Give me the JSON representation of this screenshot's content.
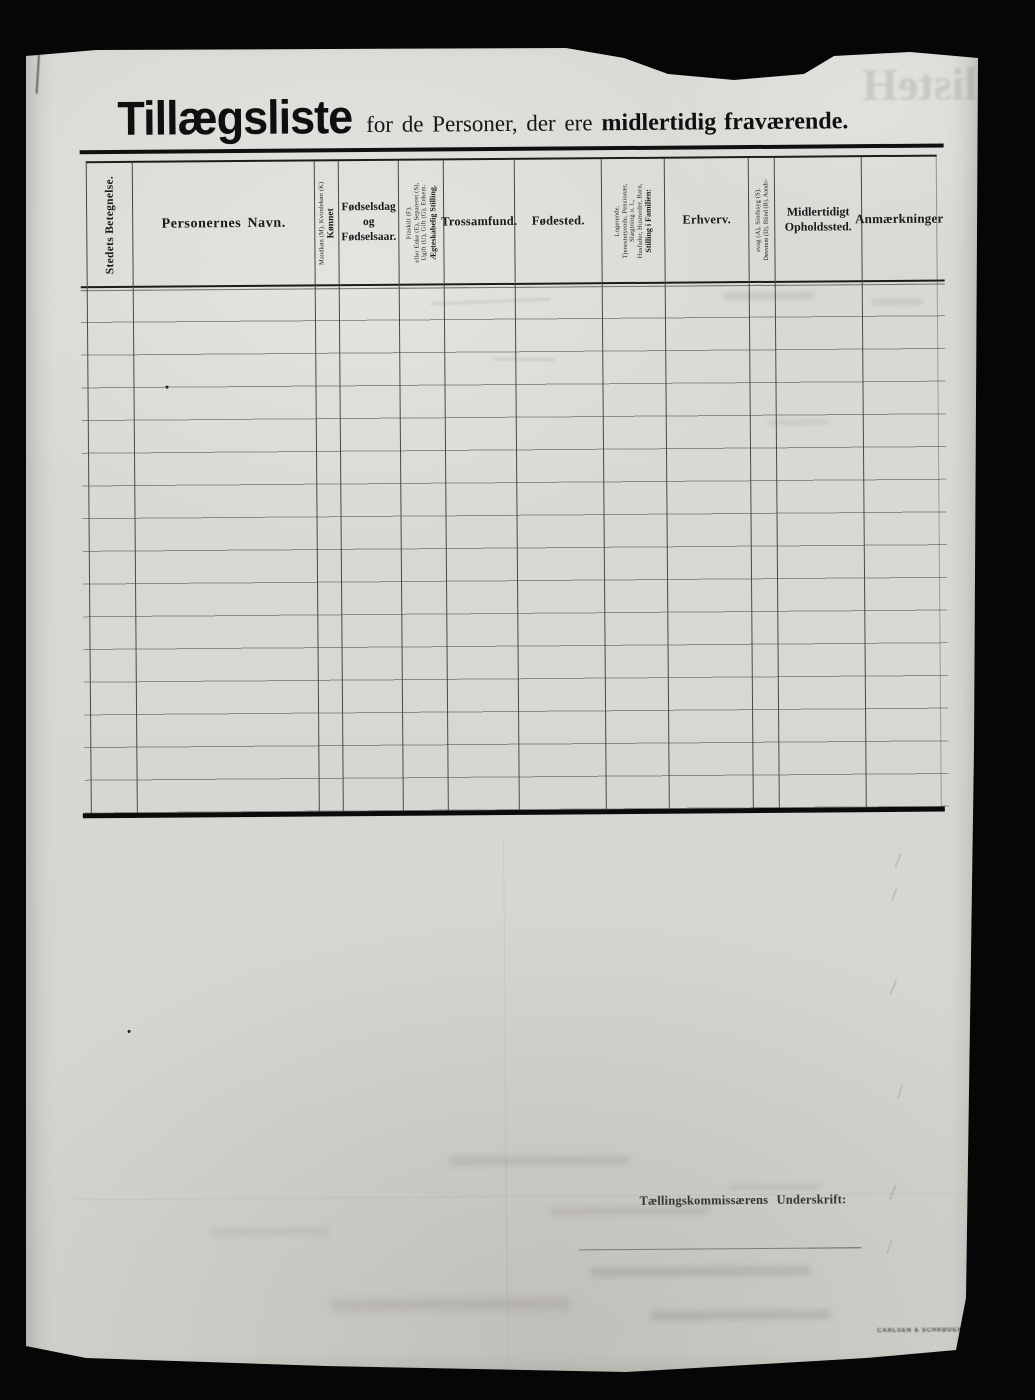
{
  "document": {
    "ghost_bleedthrough": "listeH",
    "title": {
      "main": "Tillægsliste",
      "mid": "for de Personer, der ere",
      "emphasis": "midlertidig fraværende."
    },
    "signature_label": "Tællingskommissærens Underskrift:",
    "printer_mark": "CARLSEN & SCHRØDER"
  },
  "table": {
    "row_count": 16,
    "columns": [
      {
        "key": "stedets_betegnelse",
        "orientation": "vertical",
        "main": "Stedets Betegnelse.",
        "sub": []
      },
      {
        "key": "personernes_navn",
        "orientation": "horizontal",
        "lines": [
          "Personernes Navn."
        ]
      },
      {
        "key": "kjonnet",
        "orientation": "vertical",
        "main": "Kønnet",
        "sub": [
          "Mandkøn (M), Kvindekøn (K)"
        ]
      },
      {
        "key": "fodselsdag_og_fodselsaar",
        "orientation": "horizontal",
        "lines": [
          "Fødselsdag",
          "og",
          "Fødselsaar."
        ]
      },
      {
        "key": "aegteskabelig_stilling",
        "orientation": "vertical",
        "main": "Ægteskabelig Stilling.",
        "sub": [
          "Ugift (U), Gift (G), Enkem.",
          "eller Enke (E), Separeret (S),",
          "Fraskilt (F)."
        ]
      },
      {
        "key": "trossamfund",
        "orientation": "horizontal",
        "lines": [
          "Trossamfund."
        ]
      },
      {
        "key": "fodested",
        "orientation": "horizontal",
        "lines": [
          "Fødested."
        ]
      },
      {
        "key": "stilling_i_familien",
        "orientation": "vertical",
        "main": "Stilling i Familien:",
        "sub": [
          "Husfader, Husmoder, Barn,",
          "Slægtning o. l.,",
          "Tjenestetyende, Pensionær,",
          "Logerende."
        ]
      },
      {
        "key": "erhverv",
        "orientation": "horizontal",
        "lines": [
          "Erhverv."
        ]
      },
      {
        "key": "dovstum_blind",
        "orientation": "vertical",
        "main": "Døvstum (D), Blind (B), Aands-",
        "sub": [
          "svag (A), Sindssyg (S)."
        ]
      },
      {
        "key": "midlertidigt_opholdssted",
        "orientation": "horizontal",
        "lines": [
          "Midlertidigt",
          "Opholdssted."
        ]
      },
      {
        "key": "anmaerkninger",
        "orientation": "horizontal",
        "lines": [
          "Anmærkninger"
        ]
      }
    ]
  },
  "colors": {
    "paper": "#d9d8d4",
    "ink": "#141414",
    "faint_line": "#5c5a54",
    "scan_background": "#060606"
  }
}
